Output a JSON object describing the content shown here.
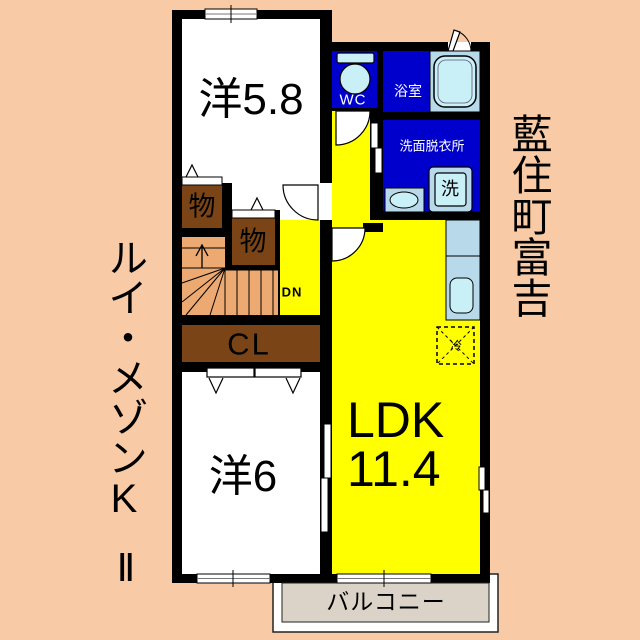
{
  "plan": {
    "rooms": {
      "western1": {
        "label": "洋5.8"
      },
      "western2": {
        "label": "洋6"
      },
      "ldk": {
        "name": "LDK",
        "size": "11.4"
      },
      "wc": {
        "label": "WC"
      },
      "bath": {
        "label": "浴室"
      },
      "washroom": {
        "label": "洗面脱衣所"
      },
      "closet": {
        "label": "CL"
      },
      "storage1": {
        "label": "物"
      },
      "storage2": {
        "label": "物"
      },
      "balcony": {
        "label": "バルコニー"
      }
    },
    "fixtures": {
      "washing_machine": "洗",
      "refrigerator": "冷"
    },
    "stairs": {
      "direction": "DN"
    }
  },
  "annotations": {
    "building_name": "ルイ・メゾンK",
    "building_name_suffix": "Ⅱ",
    "address": "藍住町富吉"
  },
  "icons": [
    "toilet-icon",
    "bathtub-icon",
    "washing-machine-icon",
    "sink-icon",
    "kitchen-counter-icon",
    "fridge-icon",
    "stairs-icon",
    "door-arc-icon",
    "window-icon",
    "sliding-door-icon"
  ],
  "colors": {
    "background": "#F8CBA6",
    "wall": "#000000",
    "room_white": "#FFFFFF",
    "ldk_yellow": "#FFFF00",
    "wet_area_blue": "#0000CC",
    "fixture_blue": "#B8D9EA",
    "fixture_inner_blue": "#C9F0F7",
    "storage_brown": "#7B4416",
    "stairs_tan": "#ECAA72",
    "balcony_gray": "#DBD3C7"
  }
}
